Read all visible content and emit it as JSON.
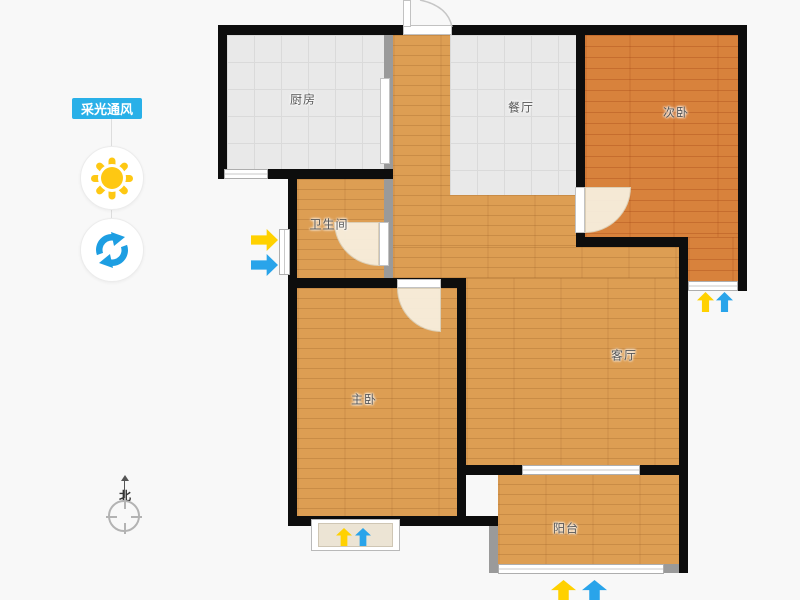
{
  "app": {
    "background_color": "#f8f8f8",
    "accent_blue": "#29b0e8"
  },
  "sidebar": {
    "tag_label": "采光通风",
    "sun_icon_color": "#fec813",
    "refresh_icon_color": "#1d9ee2",
    "compass_label": "北"
  },
  "floorplan": {
    "wall_color": "#0d0d0d",
    "partition_color": "#9a9a9a",
    "wood_floor_color": "#dd9e53",
    "bedroom2_floor_color": "#d8823c",
    "tile_floor_color": "#e9e9e9",
    "daylight_arrow_color": "#ffd100",
    "ventilation_arrow_color": "#29a4ea",
    "rooms": {
      "kitchen": "厨房",
      "dining": "餐厅",
      "bedroom2": "次卧",
      "bathroom": "卫生间",
      "living": "客厅",
      "master": "主卧",
      "balcony": "阳台"
    }
  }
}
